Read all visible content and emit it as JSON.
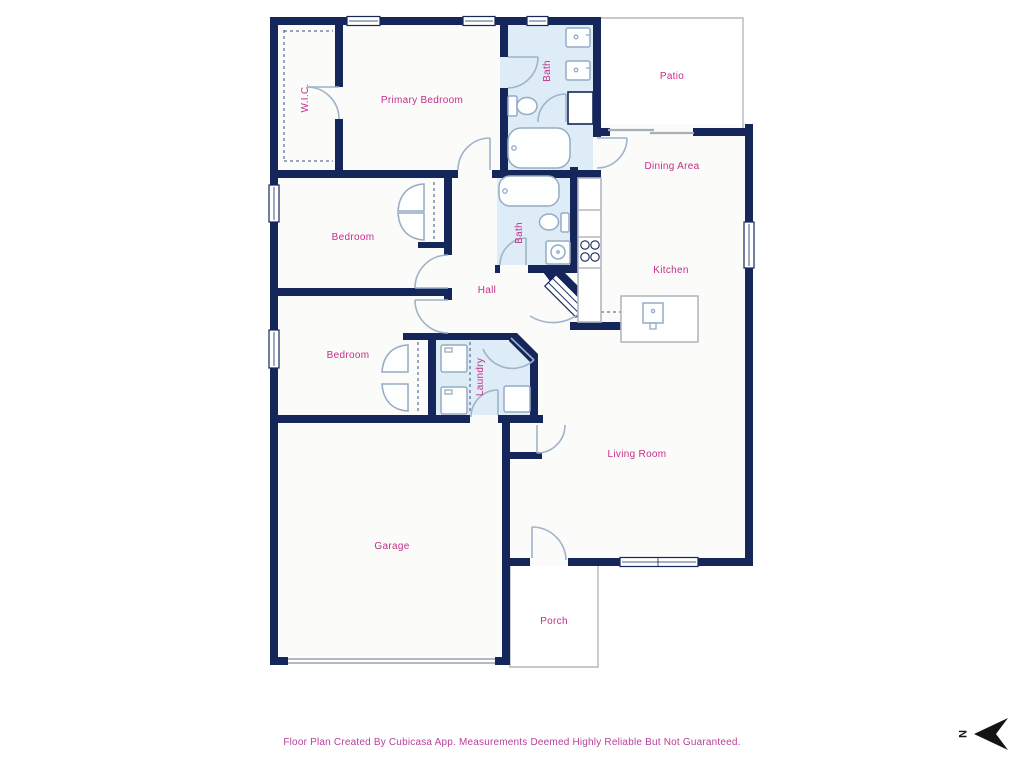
{
  "title": "Floor Plan",
  "colors": {
    "wall": "#15265b",
    "bath_fill": "#ddecf7",
    "floor": "#fbfbf9",
    "label": "#c52e8a",
    "fixture_stroke": "#96abc4",
    "door_stroke": "#9fb3c9",
    "outline_gray": "#b2b8bf"
  },
  "rooms": {
    "wic": {
      "label": "W.I.C."
    },
    "primary": {
      "label": "Primary Bedroom"
    },
    "bath_top": {
      "label": "Bath"
    },
    "patio": {
      "label": "Patio"
    },
    "dining": {
      "label": "Dining Area"
    },
    "bedroom_mid": {
      "label": "Bedroom"
    },
    "bath_mid": {
      "label": "Bath"
    },
    "kitchen": {
      "label": "Kitchen"
    },
    "hall": {
      "label": "Hall"
    },
    "bedroom_low": {
      "label": "Bedroom"
    },
    "laundry": {
      "label": "Laundry"
    },
    "living": {
      "label": "Living Room"
    },
    "garage": {
      "label": "Garage"
    },
    "porch": {
      "label": "Porch"
    }
  },
  "fixtures": [
    "vanity-sink",
    "vanity-sink",
    "toilet",
    "bathtub",
    "bathtub",
    "toilet",
    "sink",
    "washer",
    "dryer",
    "water-heater",
    "stove-burners",
    "kitchen-counter",
    "kitchen-island",
    "island-sink"
  ],
  "footer": {
    "text": "Floor Plan Created By Cubicasa App. Measurements Deemed Highly Reliable But Not Guaranteed."
  },
  "compass": {
    "label": "N"
  }
}
